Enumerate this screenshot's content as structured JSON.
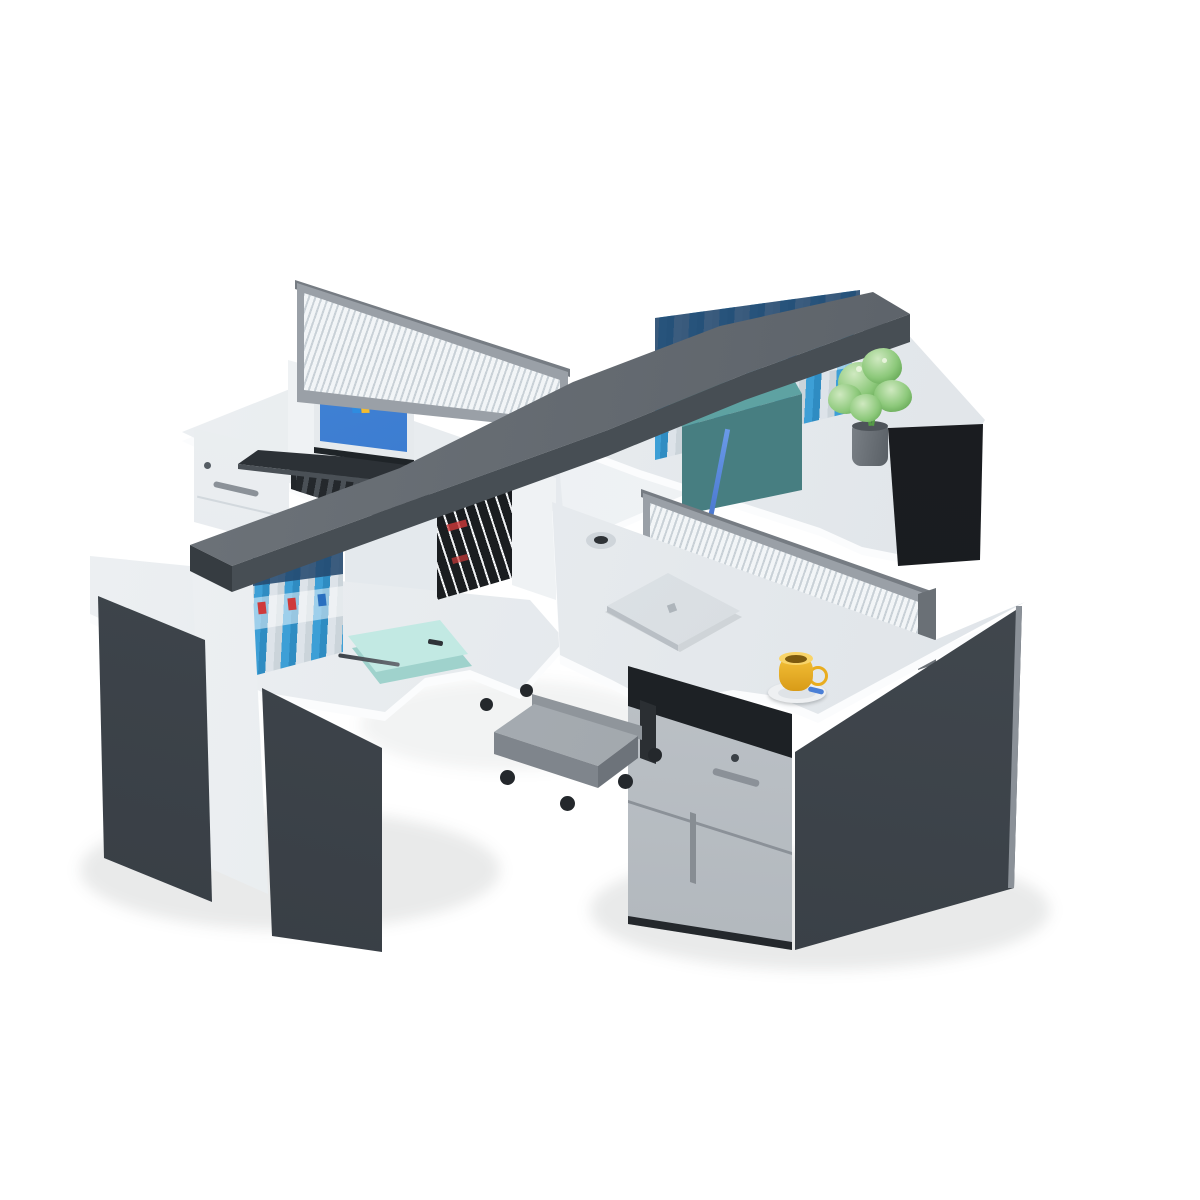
{
  "image": {
    "kind": "product-photo",
    "subject": "Four-person cross-shaped (pinwheel) office workstation cluster on a white studio background",
    "style": "isometric-like catalog render, charcoal grey and white finish"
  },
  "scene": {
    "partition": {
      "label": "Crossing privacy partitions: louvered frosted-glass screens in grey aluminium frames with a dark grey overhead shelf beam",
      "glass": "frosted glass with horizontal louver stripes",
      "beam": "dark grey top cap over white open shelving cubbies"
    },
    "workstations": {
      "rear_left": {
        "label": "Rear-left desk: open laptop showing a blue Windows-style desktop, white mobile pedestal with lock and handle, dark printer shelf under the worktop",
        "items": [
          "open laptop with blue desktop wallpaper and four-color flag logo",
          "white drawer pedestal with keyhole and handle",
          "dark printer in open shelf"
        ]
      },
      "rear_right": {
        "label": "Rear-right desk: overhead shelf with blue-and-white ring binders, teal file box with hanging blue lanyard, green potted plant on the white L-return over a black side panel",
        "items": [
          "5 ring binders (alternating blue and white spines)",
          "teal file box",
          "blue lanyard",
          "green plant in grey cylindrical pot"
        ]
      },
      "front_left": {
        "label": "Front-left desk: row of six blue-and-white ring binders under the shelf beam, mint notebook with grey pen, white pillar leg and two charcoal side panels",
        "items": [
          "6 ring binders (alternating white and blue spines with red and blue labels)",
          "mint green notebook",
          "grey pen",
          "stack of 8 black-and-white striped books in center cubby"
        ]
      },
      "front_right": {
        "label": "Front-right desk: closed silver laptop, cable grommet, yellow cup on a saucer, silver drawer pedestal with lock, charcoal cabinet body and grey CPU trolley on casters",
        "items": [
          "closed silver laptop",
          "cable grommet",
          "yellow espresso cup on saucer with blue spoon",
          "silver mobile pedestal with lock, bar handle and tall door",
          "grey CPU holder trolley with four casters"
        ]
      }
    },
    "counts": {
      "desks": 4,
      "binders_front_left": 6,
      "binders_rear_right": 5,
      "striped_books": 8,
      "casters_visible": 6
    }
  },
  "palette": {
    "bg": "#ffffff",
    "desk_a": "#eff2f4",
    "desk_b": "#dce1e6",
    "edge": "#fbfcfd",
    "dark_a": "#4a5157",
    "dark_b": "#343a41",
    "black": "#15171a",
    "hutch_a": "#71777d",
    "hutch_b": "#555b62",
    "hutch_face": "#474e54",
    "hutch_end": "#363c41",
    "white_p": "#eff2f4",
    "recess": "#e4e9ed",
    "frame": "#9aa0a7",
    "cap": "#767c83",
    "stripe_a": "#f2f5f7",
    "stripe_b": "#c9d1d7",
    "blue_a": "#3d9fd6",
    "blue_b": "#2f8cc2",
    "gsp_a": "#dde3e9",
    "gsp_b": "#cbd4da",
    "navy": "#24496e",
    "red": "#cf3a3a",
    "label_blue": "#2a6fbf",
    "book_d": "#1a1d20",
    "book_l": "#eef0f2",
    "teal_a": "#5ea2a2",
    "teal_b": "#477e81",
    "lan": "#4a7fd6",
    "leaf_a": "#cfe9c0",
    "leaf_b": "#8cc87a",
    "leaf_c": "#559a46",
    "pot_a": "#7a8086",
    "pot_b": "#595f65",
    "scr_a": "#4e94e8",
    "scr_b": "#1e55a8",
    "lap_d": "#2c3136",
    "lap_e": "#4a5056",
    "mint_a": "#c2e9e3",
    "mint_b": "#9fd2cc",
    "pen": "#3c4248",
    "cup_a": "#f5c23a",
    "cup_b": "#d89b18",
    "saucer": "#eef0f2",
    "sil_a": "#d3d8dc",
    "sil_b": "#a8aeb4",
    "metal": "#8b9198",
    "cart_a": "#b0b6bb",
    "cart_b": "#989ea4",
    "cart_c": "#7f858c",
    "caster": "#24282c",
    "win_red": "#e8502e",
    "win_green": "#7db832",
    "win_blue": "#2f8ce0",
    "win_yellow": "#f3bb2f"
  }
}
